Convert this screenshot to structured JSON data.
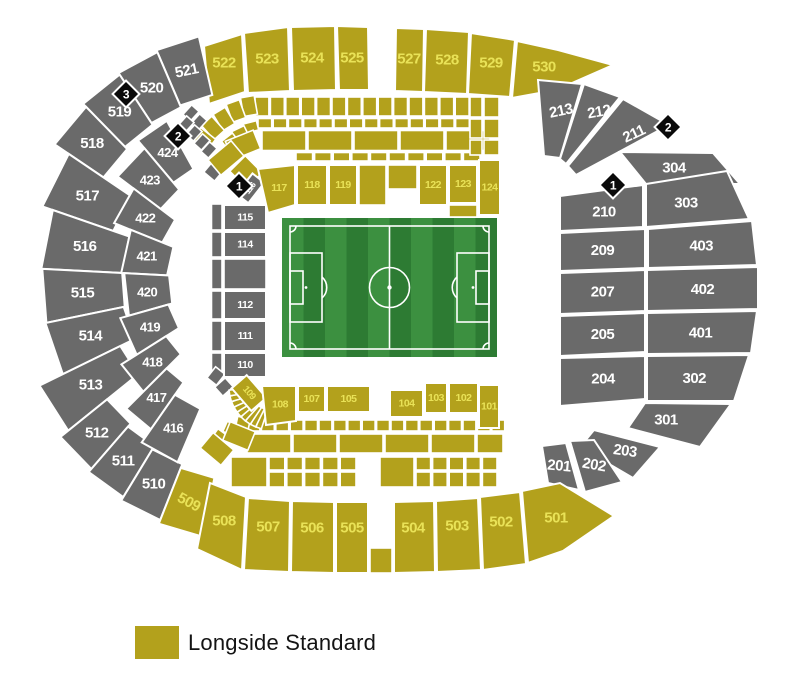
{
  "legend": {
    "label": "Longside Standard"
  },
  "colors": {
    "standard": "#b3a11c",
    "standard_label": "#e9e257",
    "unavailable": "#6a6a6a",
    "unavailable_label": "#ffffff",
    "marker_bg": "#0a0a0a",
    "marker_label": "#ffffff",
    "pitch_light": "#3c9040",
    "pitch_dark": "#2d7b33",
    "pitch_line": "#ffffff",
    "background": "#ffffff"
  },
  "markers": [
    {
      "label": "3"
    },
    {
      "label": "2"
    },
    {
      "label": "1"
    },
    {
      "label": "2"
    },
    {
      "label": "1"
    }
  ],
  "sections": [
    {
      "label": "522",
      "category": "standard"
    },
    {
      "label": "523",
      "category": "standard"
    },
    {
      "label": "524",
      "category": "standard"
    },
    {
      "label": "525",
      "category": "standard"
    },
    {
      "label": "527",
      "category": "standard"
    },
    {
      "label": "528",
      "category": "standard"
    },
    {
      "label": "529",
      "category": "standard"
    },
    {
      "label": "530",
      "category": "standard"
    },
    {
      "label": "521",
      "category": "unavailable"
    },
    {
      "label": "520",
      "category": "unavailable"
    },
    {
      "label": "519",
      "category": "unavailable"
    },
    {
      "label": "518",
      "category": "unavailable"
    },
    {
      "label": "517",
      "category": "unavailable"
    },
    {
      "label": "516",
      "category": "unavailable"
    },
    {
      "label": "515",
      "category": "unavailable"
    },
    {
      "label": "514",
      "category": "unavailable"
    },
    {
      "label": "513",
      "category": "unavailable"
    },
    {
      "label": "512",
      "category": "unavailable"
    },
    {
      "label": "511",
      "category": "unavailable"
    },
    {
      "label": "510",
      "category": "unavailable"
    },
    {
      "label": "509",
      "category": "standard"
    },
    {
      "label": "424",
      "category": "unavailable"
    },
    {
      "label": "423",
      "category": "unavailable"
    },
    {
      "label": "422",
      "category": "unavailable"
    },
    {
      "label": "421",
      "category": "unavailable"
    },
    {
      "label": "420",
      "category": "unavailable"
    },
    {
      "label": "419",
      "category": "unavailable"
    },
    {
      "label": "418",
      "category": "unavailable"
    },
    {
      "label": "417",
      "category": "unavailable"
    },
    {
      "label": "416",
      "category": "unavailable"
    },
    {
      "label": "116",
      "category": "unavailable"
    },
    {
      "label": "115",
      "category": "unavailable"
    },
    {
      "label": "114",
      "category": "unavailable"
    },
    {
      "label": "112",
      "category": "unavailable"
    },
    {
      "label": "111",
      "category": "unavailable"
    },
    {
      "label": "110",
      "category": "unavailable"
    },
    {
      "label": "109",
      "category": "standard"
    },
    {
      "label": "117",
      "category": "standard"
    },
    {
      "label": "118",
      "category": "standard"
    },
    {
      "label": "119",
      "category": "standard"
    },
    {
      "label": "122",
      "category": "standard"
    },
    {
      "label": "123",
      "category": "standard"
    },
    {
      "label": "124",
      "category": "standard"
    },
    {
      "label": "108",
      "category": "standard"
    },
    {
      "label": "107",
      "category": "standard"
    },
    {
      "label": "105",
      "category": "standard"
    },
    {
      "label": "104",
      "category": "standard"
    },
    {
      "label": "103",
      "category": "standard"
    },
    {
      "label": "102",
      "category": "standard"
    },
    {
      "label": "101",
      "category": "standard"
    },
    {
      "label": "213",
      "category": "unavailable"
    },
    {
      "label": "212",
      "category": "unavailable"
    },
    {
      "label": "211",
      "category": "unavailable"
    },
    {
      "label": "304",
      "category": "unavailable"
    },
    {
      "label": "303",
      "category": "unavailable"
    },
    {
      "label": "210",
      "category": "unavailable"
    },
    {
      "label": "209",
      "category": "unavailable"
    },
    {
      "label": "403",
      "category": "unavailable"
    },
    {
      "label": "207",
      "category": "unavailable"
    },
    {
      "label": "402",
      "category": "unavailable"
    },
    {
      "label": "205",
      "category": "unavailable"
    },
    {
      "label": "401",
      "category": "unavailable"
    },
    {
      "label": "204",
      "category": "unavailable"
    },
    {
      "label": "302",
      "category": "unavailable"
    },
    {
      "label": "301",
      "category": "unavailable"
    },
    {
      "label": "203",
      "category": "unavailable"
    },
    {
      "label": "202",
      "category": "unavailable"
    },
    {
      "label": "201",
      "category": "unavailable"
    },
    {
      "label": "508",
      "category": "standard"
    },
    {
      "label": "507",
      "category": "standard"
    },
    {
      "label": "506",
      "category": "standard"
    },
    {
      "label": "505",
      "category": "standard"
    },
    {
      "label": "504",
      "category": "standard"
    },
    {
      "label": "503",
      "category": "standard"
    },
    {
      "label": "502",
      "category": "standard"
    },
    {
      "label": "501",
      "category": "standard"
    }
  ]
}
